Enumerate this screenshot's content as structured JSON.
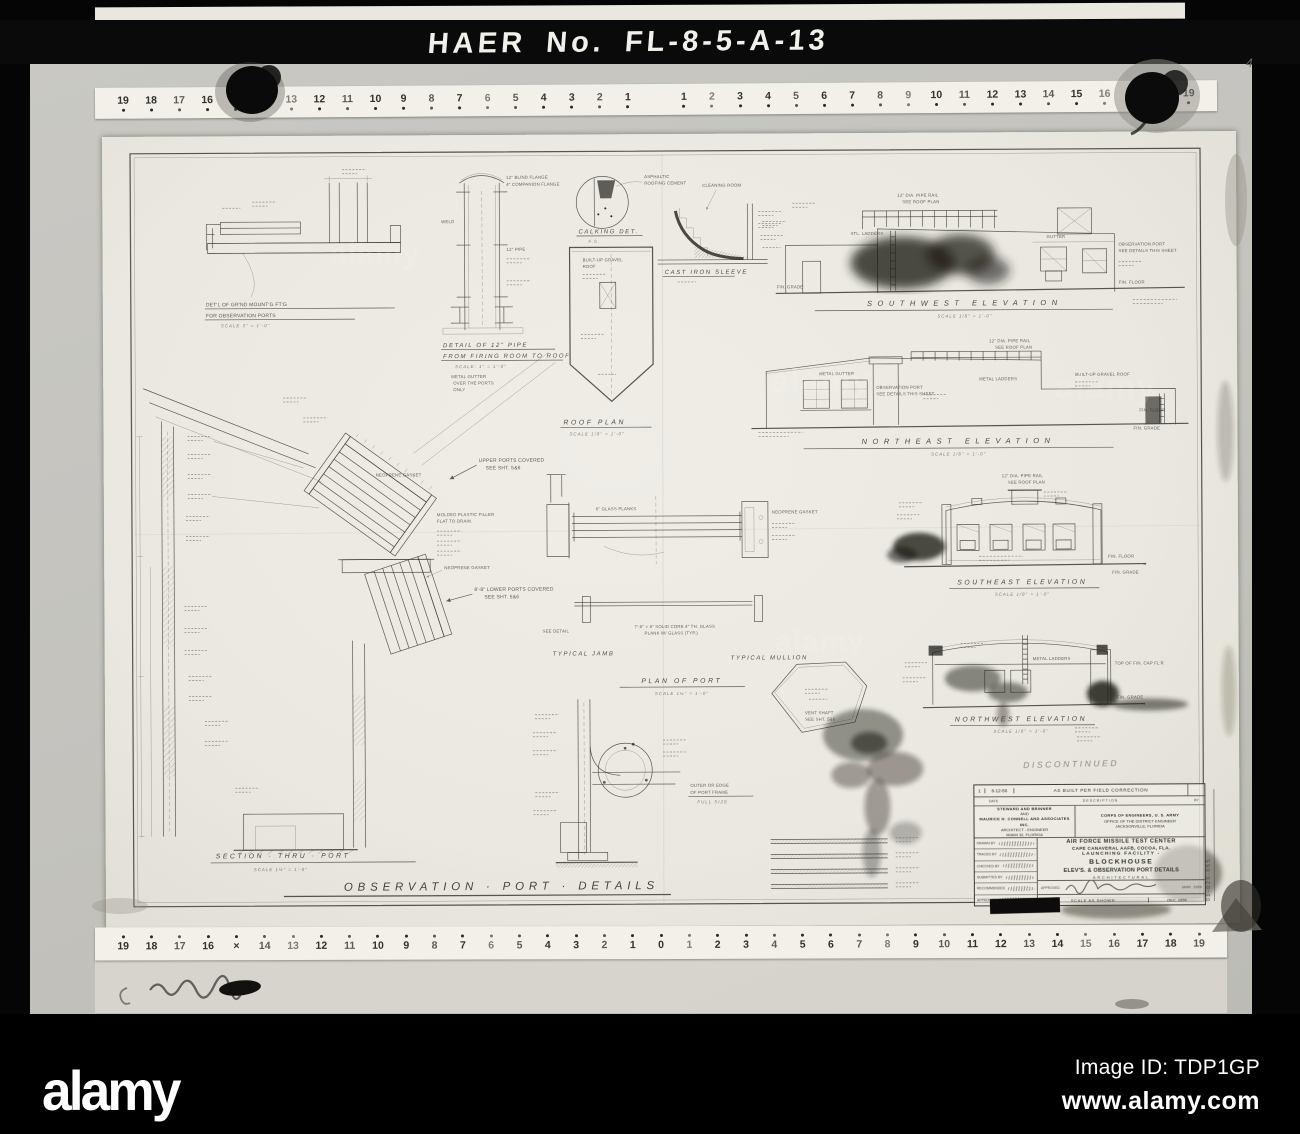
{
  "overlay": {
    "haer_label": "HAER No. FL-8-5-A-13",
    "corner_mark": "4",
    "watermark_brand": "alamy",
    "footer": {
      "brand": "alamy",
      "image_id": "Image ID: TDP1GP",
      "url": "www.alamy.com"
    }
  },
  "rulers": {
    "top": [
      "19",
      "18",
      "17",
      "16",
      "15",
      "14",
      "13",
      "12",
      "11",
      "10",
      "9",
      "8",
      "7",
      "6",
      "5",
      "4",
      "3",
      "2",
      "1",
      "1",
      "2",
      "3",
      "4",
      "5",
      "6",
      "7",
      "8",
      "9",
      "10",
      "11",
      "12",
      "13",
      "14",
      "15",
      "16",
      "17",
      "18",
      "19"
    ],
    "bottom": [
      "19",
      "18",
      "17",
      "16",
      "×",
      "14",
      "13",
      "12",
      "11",
      "10",
      "9",
      "8",
      "7",
      "6",
      "5",
      "4",
      "3",
      "2",
      "1",
      "0",
      "1",
      "2",
      "3",
      "4",
      "5",
      "6",
      "7",
      "8",
      "9",
      "10",
      "11",
      "12",
      "13",
      "14",
      "15",
      "16",
      "17",
      "18",
      "19"
    ]
  },
  "sheet": {
    "titles": {
      "t_main": "OBSERVATION · PORT · DETAILS",
      "t_section": "SECTION · THRU · PORT",
      "t_sw": "SOUTHWEST ELEVATION",
      "t_ne": "NORTHEAST ELEVATION",
      "t_se": "SOUTHEAST ELEVATION",
      "t_nw": "NORTHWEST ELEVATION",
      "t_roof": "ROOF PLAN",
      "t_jamb": "TYPICAL JAMB",
      "t_mull": "TYPICAL MULLION",
      "t_plan": "PLAN OF PORT",
      "t_calk": "CALKING DET.",
      "t_pipe1": "DETAIL OF 12\" PIPE",
      "t_pipe2": "FROM FIRING ROOM TO ROOF",
      "t_gnd1": "DET'L OF GR'ND MOUNT'G FT'G",
      "t_gnd2": "FOR OBSERVATION PORTS",
      "t_cast": "CAST IRON SLEEVE"
    },
    "scales": {
      "eighth": "SCALE 1/8\" = 1'-0\"",
      "sesqui": "SCALE 1½\" = 1'-0\"",
      "inch": "SCALE: 1\" = 1'-0\"",
      "three": "SCALE 3\" = 1'-0\"",
      "fs": "F.S."
    },
    "notes": {
      "upper1": "UPPER PORTS COVERED",
      "upper2": "SEE SHT. 5&6",
      "lower1": "8'-8\" LOWER PORTS COVERED",
      "neoprene": "NEOPRENE GASKET",
      "molded1": "MOLDED PLASTIC FILLER",
      "molded2": "FLAT TO DRAIN",
      "asph1": "ASPHALTIC",
      "asph2": "ROOFING CEMENT",
      "cleaning": "CLEANING ROOM",
      "gravel1": "BUILT-UP GRAVEL",
      "gravel2": "ROOF",
      "mgutter": "METAL GUTTER",
      "mgutter2": "OVER THE PORTS",
      "mgutter3": "ONLY",
      "blind": "12\" BLIND FLANGE",
      "companion": "4\" COMPANION FLANGE",
      "weld": "WELD",
      "pipe12": "12\" PIPE",
      "rail1": "12\" DIA. PIPE RAIL",
      "rail2": "SEE ROOF PLAN",
      "stl_ladders": "STL. LADDERS",
      "metal_ladders": "METAL LADDERS",
      "gutter": "GUTTER",
      "obs1": "OBSERVATION PORT",
      "obs2": "SEE DETAILS THIS SHEET",
      "fin_grade": "FIN. GRADE",
      "fin_floor": "FIN. FLOOR",
      "bu_roof": "BUILT-UP GRAVEL ROOF",
      "vent1": "VENT SHAFT",
      "vent2": "SEE SHT. 5&6",
      "glass6": "6\" GLASS PLANKS",
      "core1": "7'-6\" × 8\" SOLID CORE 4\" TH. GLASS",
      "core2": "PLANK W/ GLASS (TYP.)",
      "see_detail": "SEE DETAIL",
      "outer1": "OUTER OR EDGE",
      "outer2": "OF PORT FRAME",
      "outer3": "FULL SIZE",
      "top_cap": "TOP OF FIN. CAP FL'R"
    }
  },
  "titleblock": {
    "revision": {
      "no": "1",
      "date": "6-12-56",
      "desc": "AS BUILT PER FIELD CORRECTION",
      "date_header": "DATE",
      "desc_header": "DESCRIPTION",
      "by_header": "BY"
    },
    "firm": {
      "l1": "STEWARD AND BRINNER",
      "l2": "AND",
      "l3": "MAURICE H. CONNELL AND ASSOCIATES INC.",
      "l4": "ARCHITECT - ENGINEER",
      "l5": "MIAMI 32, FLORIDA"
    },
    "agency": {
      "l1": "CORPS OF ENGINEERS, U. S. ARMY",
      "l2": "OFFICE OF THE DISTRICT ENGINEER",
      "l3": "JACKSONVILLE, FLORIDA"
    },
    "project": {
      "l1": "AIR FORCE MISSILE TEST CENTER",
      "l2": "CAPE CANAVERAL AAFB, COCOA, FLA.",
      "l3": "LAUNCHING FACILITY -",
      "l4": "BLOCKHOUSE",
      "l5": "ELEV'S. & OBSERVATION PORT DETAILS",
      "l6": "ARCHITECTURAL"
    },
    "sig_rows": [
      "DRAWN BY",
      "TRACED BY",
      "CHECKED BY",
      "SUBMITTED BY",
      "RECOMMENDED",
      "APPROVED"
    ],
    "approved_label": "APPROVED",
    "approved_date": "MAR. 1956",
    "scale_note": "SCALE AS SHOWN",
    "date_note": "DEC. 1955",
    "drawing_number": "01-020-065",
    "discontinued_note": "DISCONTINUED"
  }
}
